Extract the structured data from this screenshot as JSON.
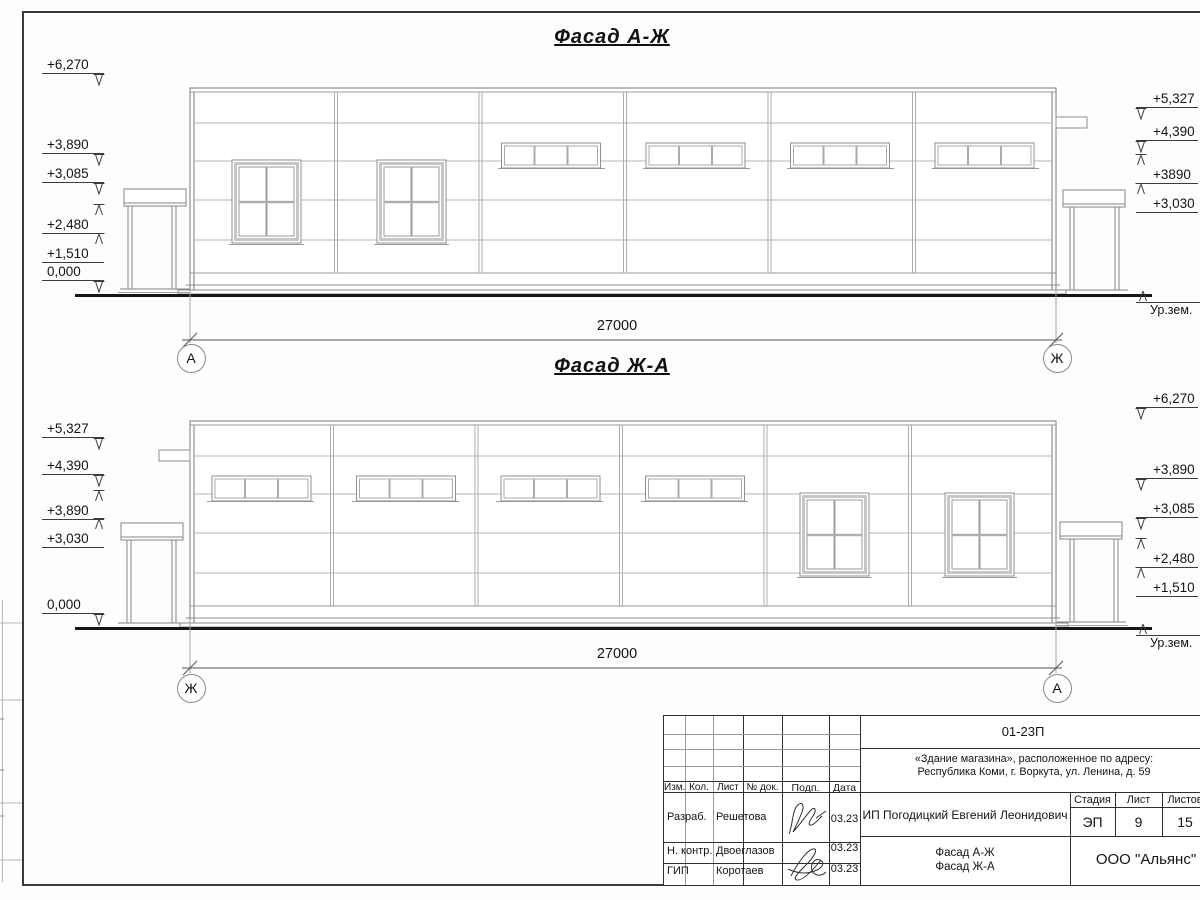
{
  "colors": {
    "ink": "#141414",
    "frame": "#3a3a3a",
    "thin_line": "#b0b0b0"
  },
  "facades": [
    {
      "title": "Фасад А-Ж",
      "dimension": "27000",
      "axis_left": "А",
      "axis_right": "Ж",
      "ground_label": "Ур.зем.",
      "marks_left": [
        "+6,270",
        "+3,890",
        "+3,085",
        "+2,480",
        "+1,510",
        "0,000"
      ],
      "marks_right": [
        "+5,327",
        "+4,390",
        "+3890",
        "+3,030"
      ]
    },
    {
      "title": "Фасад Ж-А",
      "dimension": "27000",
      "axis_left": "Ж",
      "axis_right": "А",
      "ground_label": "Ур.зем.",
      "marks_left": [
        "+5,327",
        "+4,390",
        "+3,890",
        "+3,030",
        "0,000"
      ],
      "marks_right": [
        "+6,270",
        "+3,890",
        "+3,085",
        "+2,480",
        "+1,510"
      ]
    }
  ],
  "title_block": {
    "doc_number": "01-23П",
    "object_line1": "«Здание магазина», расположенное по адресу:",
    "object_line2": "Республика Коми, г. Воркута, ул. Ленина, д. 59",
    "header_cols": [
      "Изм.",
      "Кол.",
      "Лист",
      "№ док.",
      "Подп.",
      "Дата"
    ],
    "rows": [
      {
        "role": "Разраб.",
        "name": "Решетова",
        "date": "03.23"
      },
      {
        "role": "Н. контр.",
        "name": "Двоеглазов",
        "date": "03.23"
      },
      {
        "role": "ГИП",
        "name": "Коротаев",
        "date": "03.23"
      }
    ],
    "client": "ИП Погодицкий Евгений Леонидович",
    "stage_label": "Стадия",
    "sheet_label": "Лист",
    "sheets_label": "Листов",
    "stage": "ЭП",
    "sheet_no": "9",
    "sheets_total": "15",
    "drawing_title_line1": "Фасад А-Ж",
    "drawing_title_line2": "Фасад Ж-А",
    "organization": "ООО \"Альянс\""
  }
}
